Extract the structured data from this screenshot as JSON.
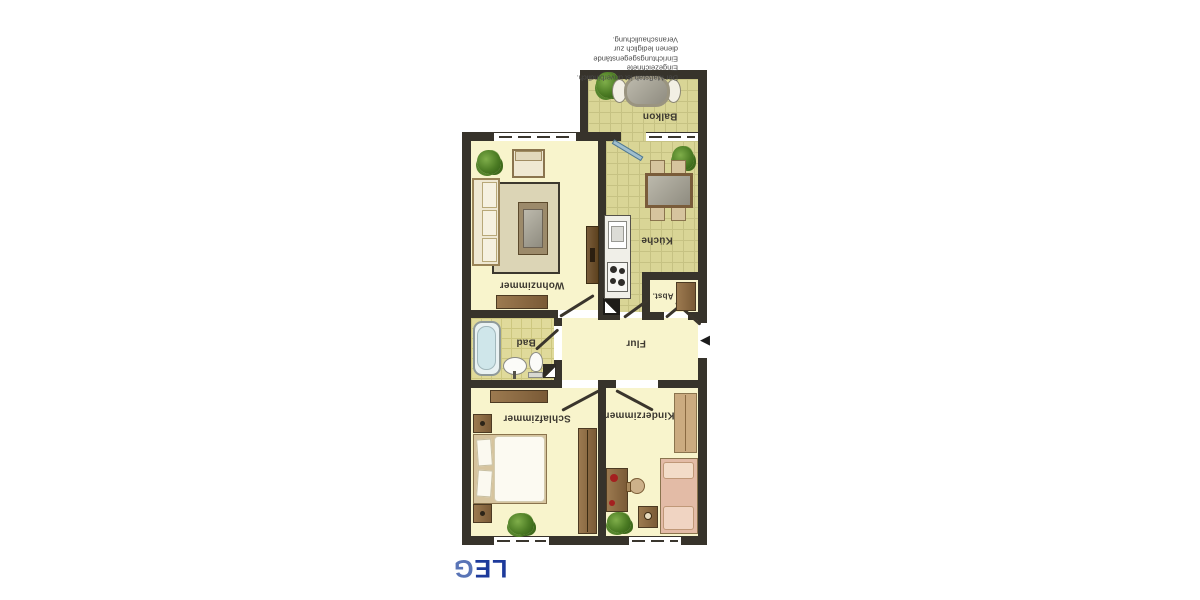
{
  "page": {
    "background": "#ffffff",
    "description_orientation": "floor plan scanned upside-down (rotated 180°)"
  },
  "branding": {
    "logo_text": "LEG",
    "logo_text_primary": "LE",
    "logo_text_accent": "G",
    "logo_primary_color": "#1d3a9b",
    "logo_accent_color": "#5974b6"
  },
  "disclaimer": {
    "lines": [
      "Der Maßstab ist unverbindlich.",
      "Eingezeichnete Einrichtungsgegenstände",
      "dienen lediglich zur Veranschaulichung."
    ]
  },
  "floorplan": {
    "rooms": [
      {
        "id": "balkon",
        "label": "Balkon"
      },
      {
        "id": "kueche",
        "label": "Küche"
      },
      {
        "id": "wohnzimmer",
        "label": "Wohnzimmer"
      },
      {
        "id": "abstellraum",
        "label": "Abst."
      },
      {
        "id": "flur",
        "label": "Flur"
      },
      {
        "id": "bad",
        "label": "Bad"
      },
      {
        "id": "schlafzimmer",
        "label": "Schlafzimmer"
      },
      {
        "id": "kinderzimmer",
        "label": "Kinderzimmer"
      }
    ],
    "entrance_marker": "◀",
    "colors": {
      "wall": "#37332b",
      "room_floor": "#f8f4cc",
      "tile_floor": "#d9d596",
      "bath_tile_floor": "#e0da9b",
      "label_text": "#3d3931"
    }
  }
}
